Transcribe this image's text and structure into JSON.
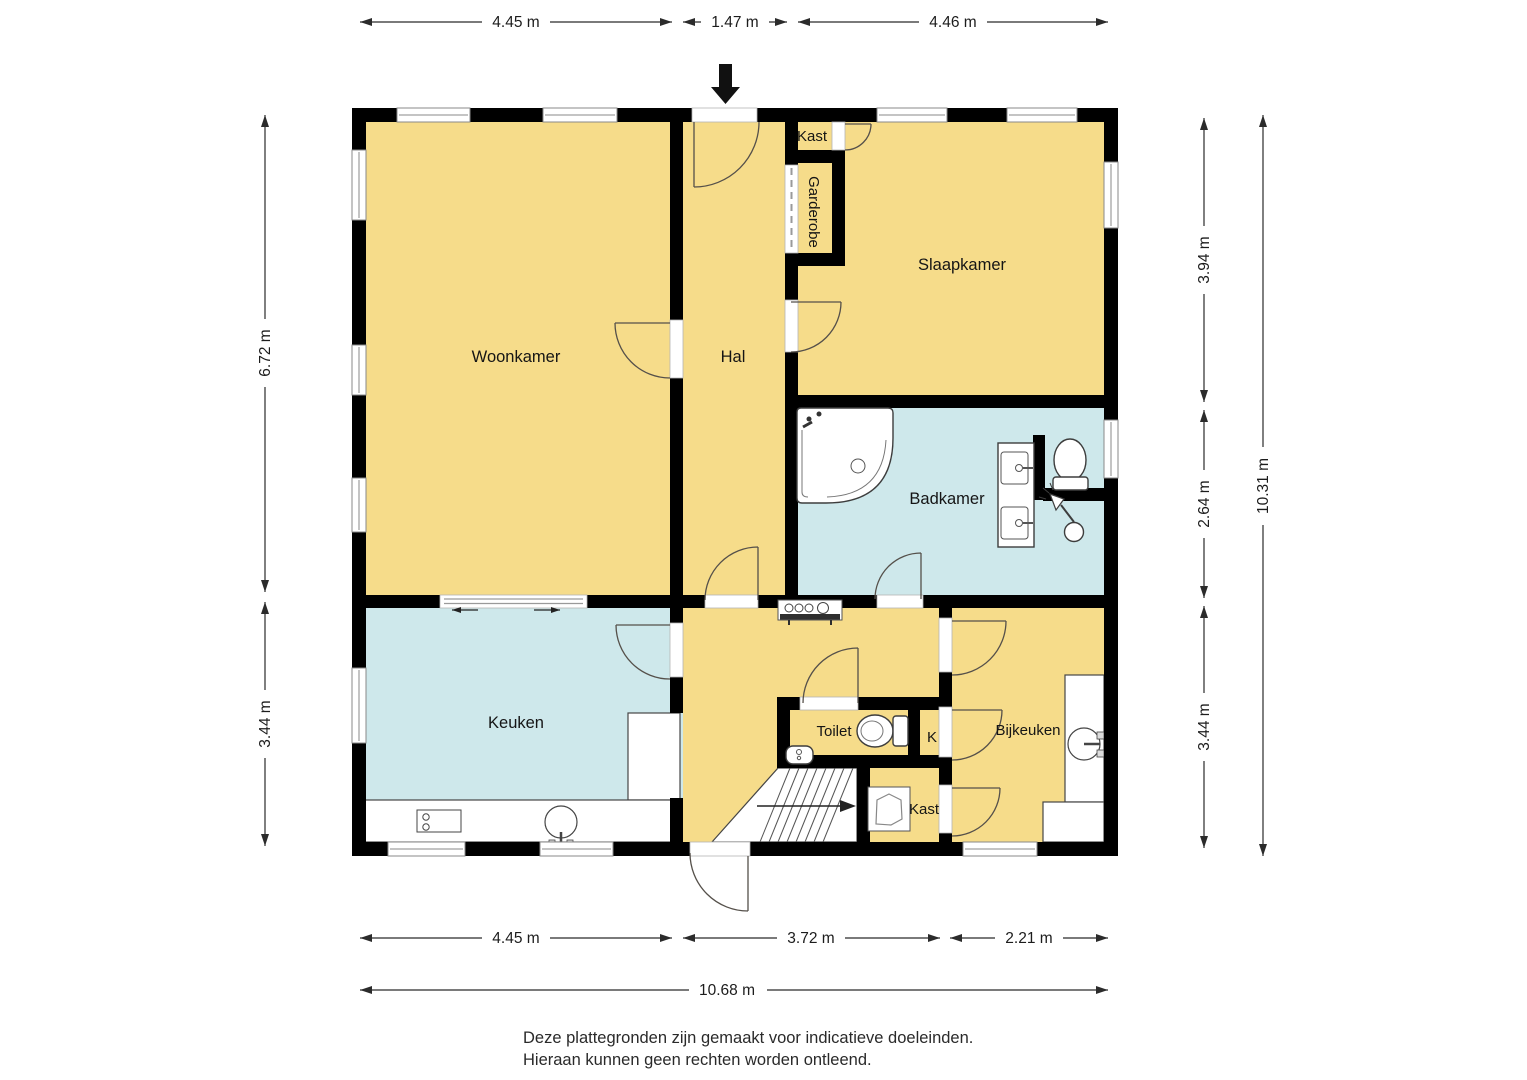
{
  "labels": {
    "woonkamer": "Woonkamer",
    "hal": "Hal",
    "kast_top": "Kast",
    "garderobe": "Garderobe",
    "slaapkamer": "Slaapkamer",
    "badkamer": "Badkamer",
    "keuken": "Keuken",
    "toilet": "Toilet",
    "k": "K",
    "bijkeuken": "Bijkeuken",
    "kast_bottom": "Kast"
  },
  "dimensions": {
    "top": [
      "4.45 m",
      "1.47 m",
      "4.46 m"
    ],
    "left": [
      "6.72 m",
      "3.44 m"
    ],
    "right": [
      "3.94 m",
      "2.64 m",
      "3.44 m"
    ],
    "right_total": "10.31 m",
    "bottom": [
      "4.45 m",
      "3.72 m",
      "2.21 m"
    ],
    "bottom_total": "10.68 m"
  },
  "footer": {
    "line1": "Deze plattegronden zijn gemaakt voor indicatieve doeleinden.",
    "line2": "Hieraan kunnen geen rechten worden ontleend."
  },
  "colors": {
    "room_fill": "#F6DC8A",
    "wet_room_fill": "#CEE8EB",
    "wall": "#000000",
    "door_line": "#55504a",
    "dim_line": "#2b2b2b"
  }
}
